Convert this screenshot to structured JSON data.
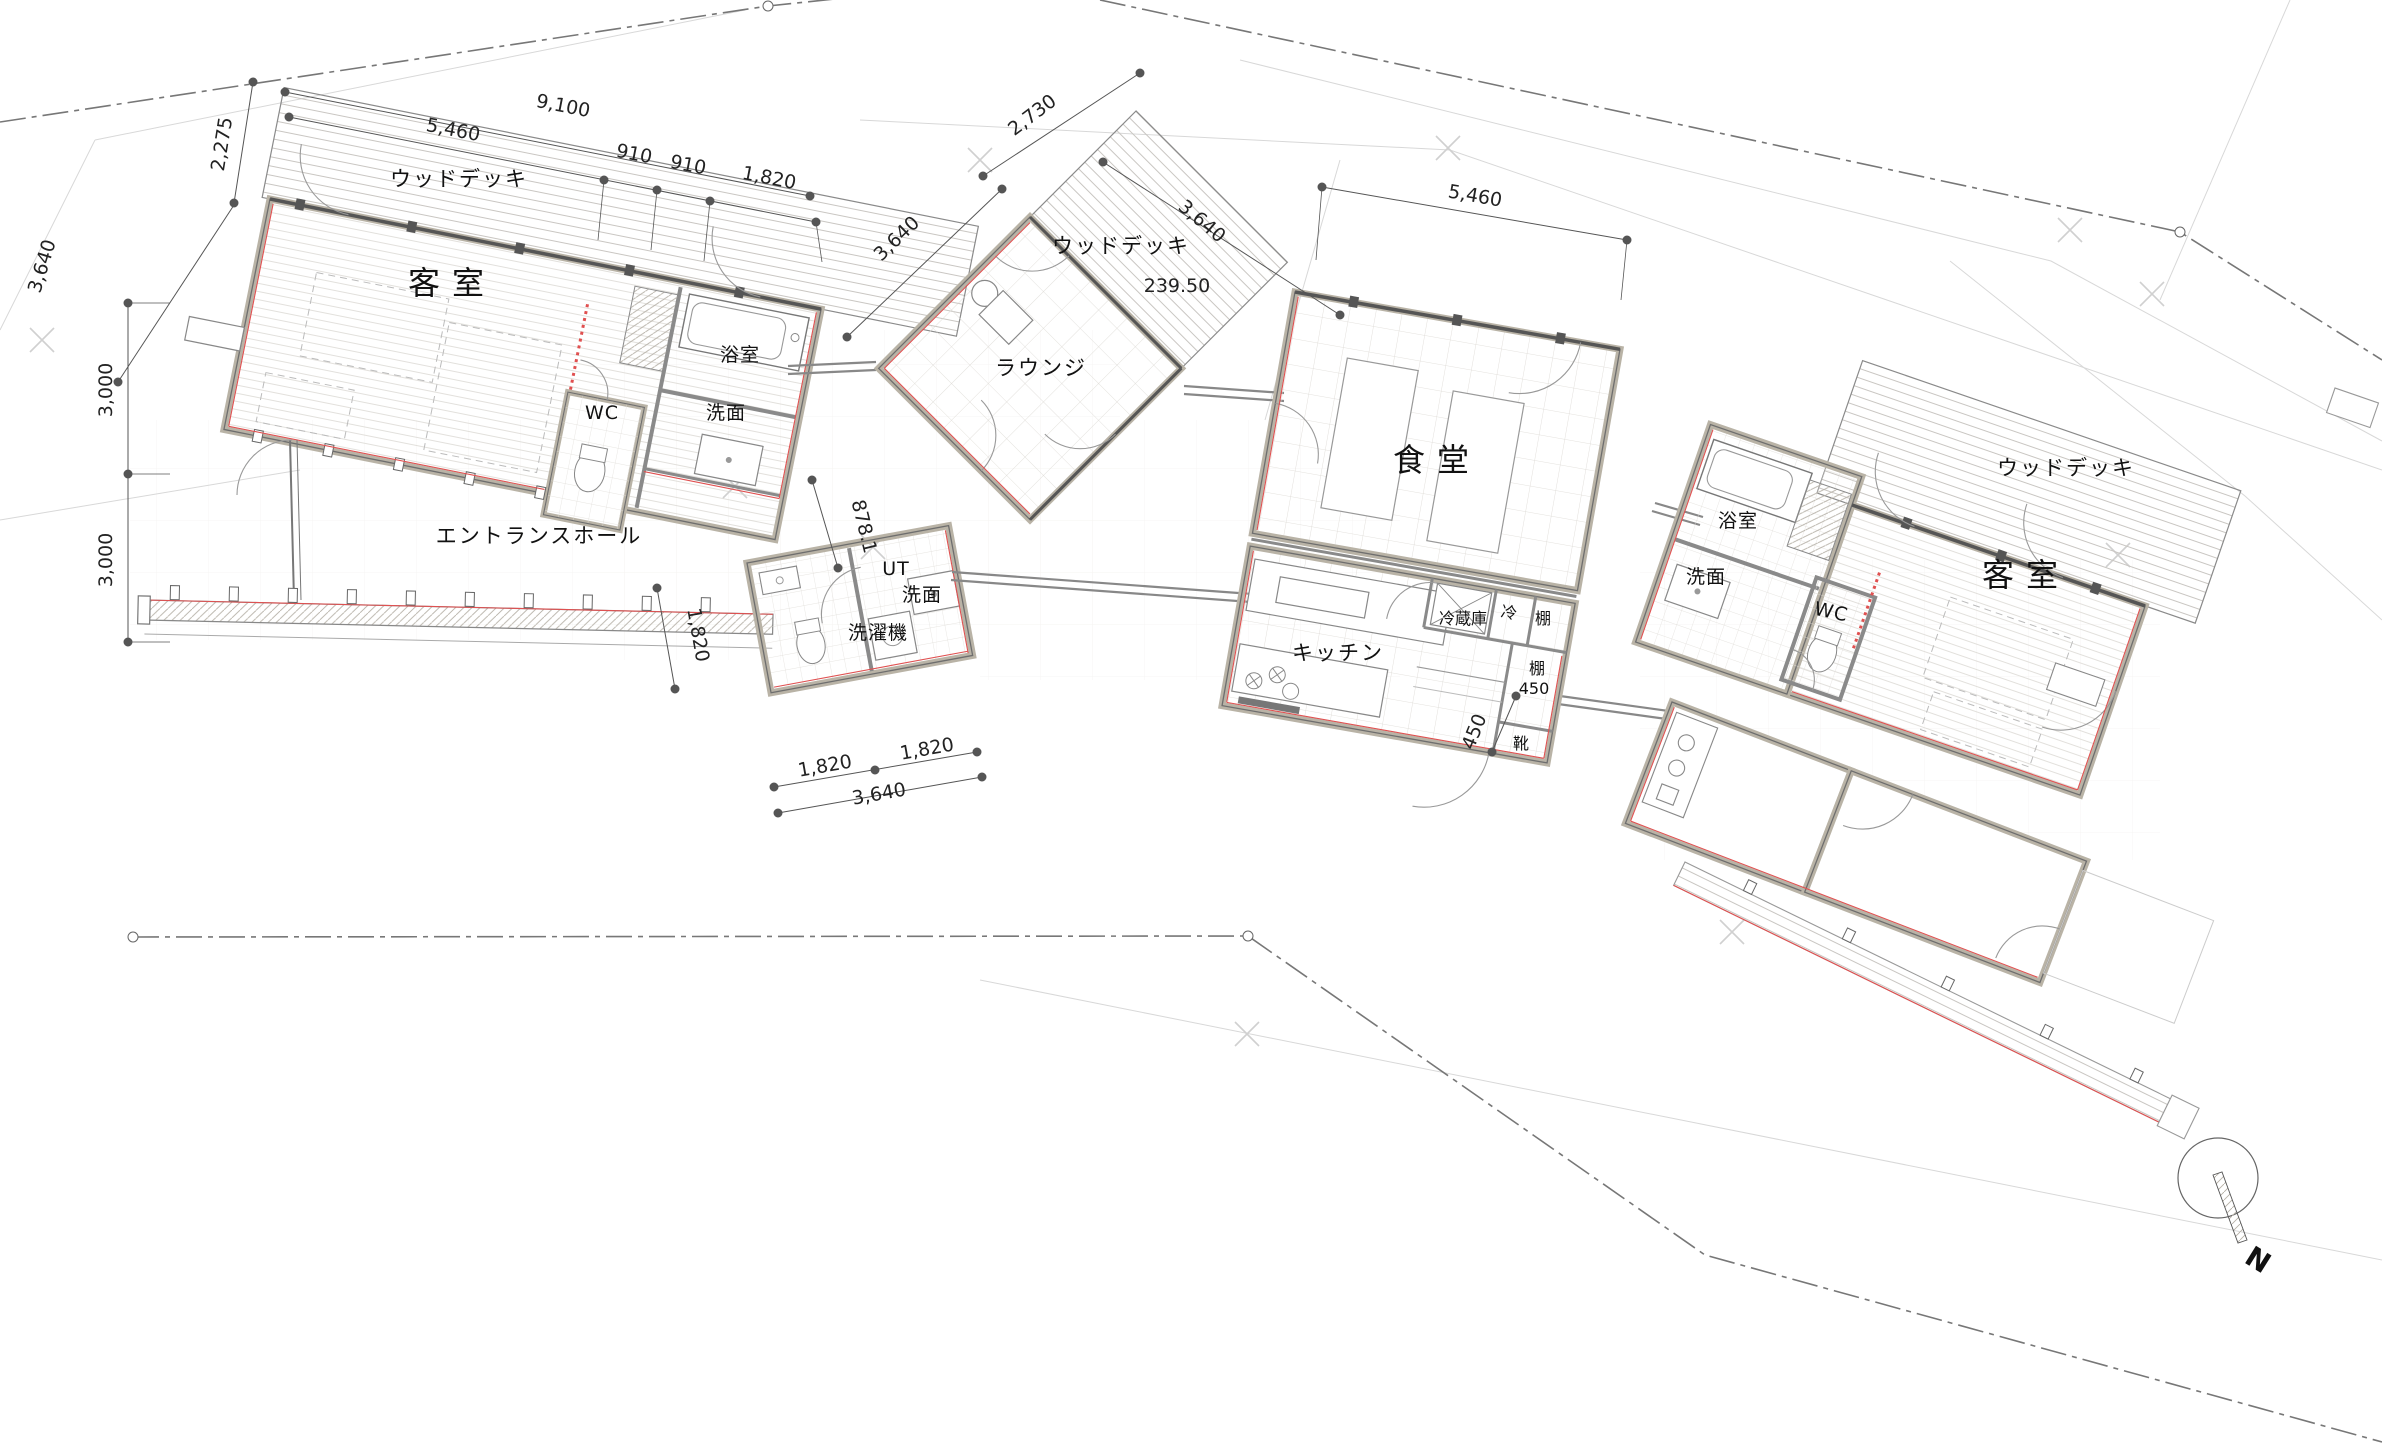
{
  "drawing": {
    "type": "architectural floor plan",
    "language": "ja"
  },
  "labels": {
    "deck_left": "ウッドデッキ",
    "guest_left": "客室",
    "bath_left": "浴室",
    "wc_left": "WC",
    "lav_left": "洗面",
    "entrance_hall": "エントランスホール",
    "lounge": "ラウンジ",
    "deck_center": "ウッドデッキ",
    "deck_level": "239.50",
    "ut": "UT",
    "lav_ut": "洗面",
    "washer": "洗濯機",
    "dining": "食堂",
    "kitchen": "キッチン",
    "fridge": "冷蔵庫",
    "cold": "冷",
    "shelf_top": "棚",
    "shelf_right": "棚",
    "shelf_right_size": "450",
    "shoes": "靴",
    "bath_right": "浴室",
    "lav_right": "洗面",
    "wc_right": "WC",
    "guest_right": "客室",
    "deck_right": "ウッドデッキ",
    "compass_n": "N"
  },
  "dimensions": {
    "d2275": "2,275",
    "d9100": "9,100",
    "d5460_left": "5,460",
    "d910a": "910",
    "d910b": "910",
    "d1820_top": "1,820",
    "d3640_site": "3,640",
    "d3000a": "3,000",
    "d3000b": "3,000",
    "d2730": "2,730",
    "d3640_lounge": "3,640",
    "d3640_deck": "3,640",
    "d5460_dining": "5,460",
    "d878": "878.1",
    "d1820_walk": "1,820",
    "d1820_b1": "1,820",
    "d1820_b2": "1,820",
    "d3640_bottom": "3,640",
    "d450_genkan": "450"
  },
  "colors": {
    "wall": "#b9b3a6",
    "line": "#666666",
    "accent_red": "#e05050",
    "hatch": "#c9c6c0",
    "boundary": "#777777"
  }
}
